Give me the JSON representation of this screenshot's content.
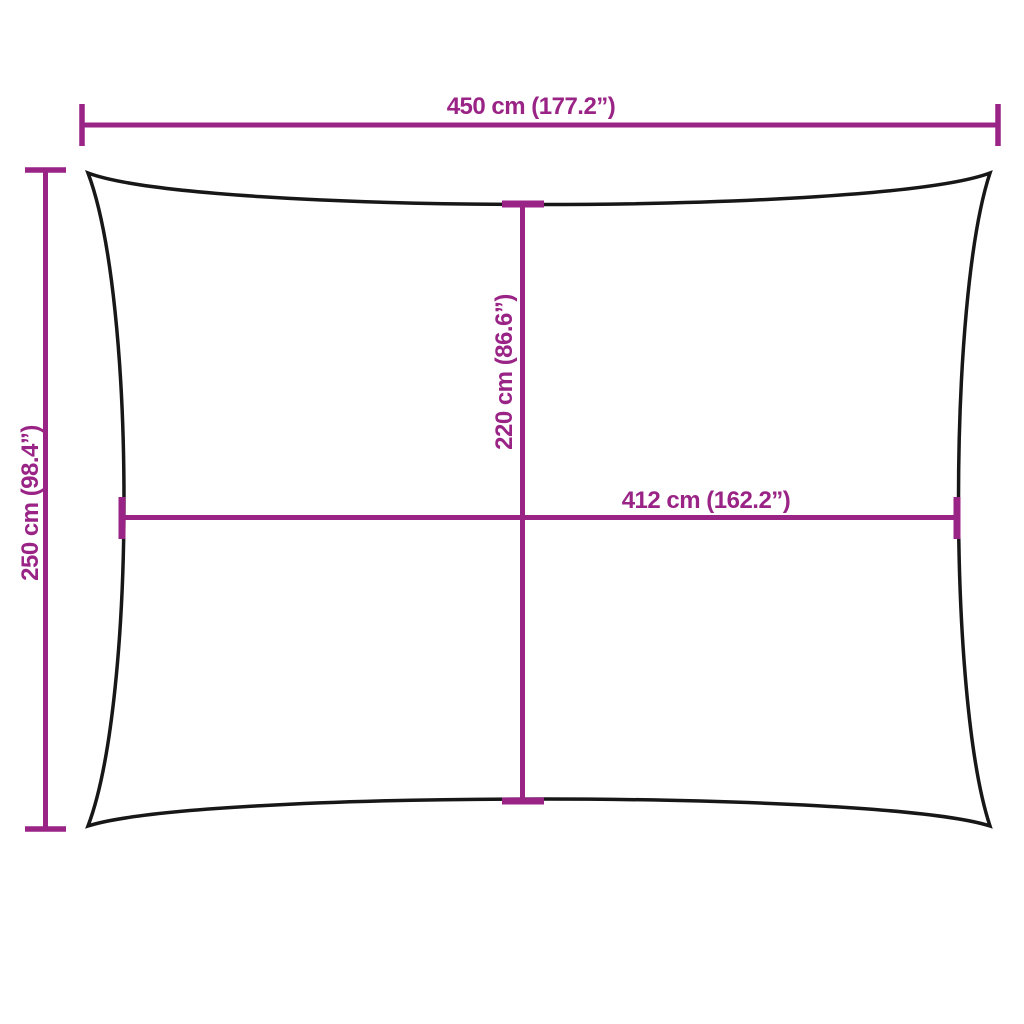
{
  "page": {
    "background_color": "#ffffff"
  },
  "diagram": {
    "kind": "product-dimension-diagram",
    "subject": "rectangular shade sail with concave edges",
    "accent_color": "#9A2386",
    "outline_color": "#171717",
    "labels": {
      "top_width": "450 cm (177.2”)",
      "left_height": "250 cm (98.4”)",
      "inner_height": "220 cm (86.6”)",
      "inner_width": "412 cm (162.2”)"
    }
  }
}
